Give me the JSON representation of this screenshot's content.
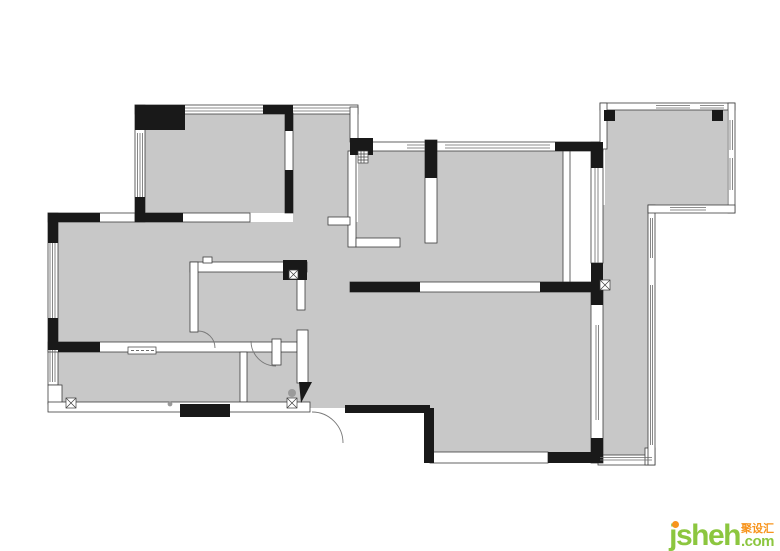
{
  "watermark": {
    "brand": "jsheh",
    "cjk": "聚设汇",
    "tld": ".com"
  },
  "colors": {
    "background": "#ffffff",
    "floor_fill": "#c8c8c8",
    "wall_black": "#191919",
    "line": "#3c3c3c",
    "window_line": "#6a6a6a",
    "brand_green": "#8cc63f",
    "brand_orange": "#f7941d"
  }
}
